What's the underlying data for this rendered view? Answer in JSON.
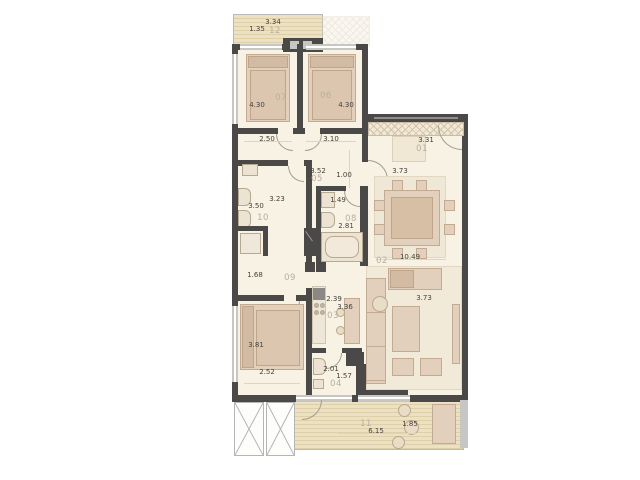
{
  "plan_title": "apartment-floor-plan",
  "colors": {
    "wall": "#4a4947",
    "floor": "#f7f2e4",
    "furniture": "#e2d0bc",
    "deck": "#ece1c2",
    "room_number_text": "#b9ae9c",
    "dimension_text": "#46413a"
  },
  "labels": {
    "b12_w": "3.34",
    "b12_d": "1.35",
    "r12": "12",
    "r07": "07",
    "r07_w": "4.30",
    "r06": "06",
    "r06_w": "4.30",
    "r07_b": "2.50",
    "r06_b": "3.10",
    "r01_w": "3.31",
    "r01": "01",
    "r05_w": "3.52",
    "r05": "05",
    "r05_d": "1.00",
    "hall_r": "3.73",
    "r10_w": "3.23",
    "r10_d": "3.50",
    "r10": "10",
    "r08_w": "1.49",
    "r08": "08",
    "r08_d": "2.81",
    "r02": "02",
    "r02_w": "10.49",
    "r02_d": "3.73",
    "r09_w": "1.68",
    "r09": "09",
    "r03_w": "2.39",
    "r03_d": "3.36",
    "r03": "03",
    "rbd_w": "3.81",
    "rbd_b": "2.52",
    "r04_w": "2.01",
    "r04_d": "1.57",
    "r04": "04",
    "r11": "11",
    "r11_w": "6.15",
    "r11_d": "1.85"
  }
}
